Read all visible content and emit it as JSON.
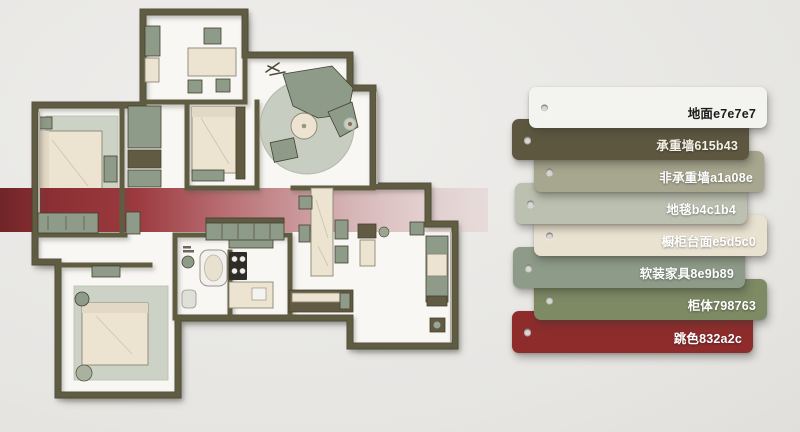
{
  "palette": {
    "cards": [
      {
        "label": "地面e7e7e7",
        "color": "#f3f3f0",
        "text_color": "#1c1c1c"
      },
      {
        "label": "承重墙615b43",
        "color": "#5e5740",
        "text_color": "#f4f1e8"
      },
      {
        "label": "非承重墙a1a08e",
        "color": "#a7a78f",
        "text_color": "#ffffff"
      },
      {
        "label": "地毯b4c1b4",
        "color": "#bcc0b0",
        "text_color": "#ffffff"
      },
      {
        "label": "橱柜台面e5d5c0",
        "color": "#eae2d1",
        "text_color": "#ffffff"
      },
      {
        "label": "软装家具8e9b89",
        "color": "#8e9b89",
        "text_color": "#ffffff"
      },
      {
        "label": "柜体798763",
        "color": "#7d8a64",
        "text_color": "#ffffff"
      },
      {
        "label": "跳色832a2c",
        "color": "#8e2c2c",
        "text_color": "#ffffff"
      }
    ]
  },
  "plan_colors": {
    "floor": "#f8f7f4",
    "wall": "#615b43",
    "wall_dark": "#45402f",
    "furniture_green": "#8e9b89",
    "furniture_green_dark": "#7d8a64",
    "furniture_cream": "#ece3d0",
    "rug": "#ccd2c5",
    "rug_round": "#c7cdc0",
    "accent_dark": "#702528",
    "accent_mid": "#9c3a3f",
    "accent_fade": "#e3d0d0",
    "stove": "#2e2c26",
    "outline": "#8b8575"
  }
}
